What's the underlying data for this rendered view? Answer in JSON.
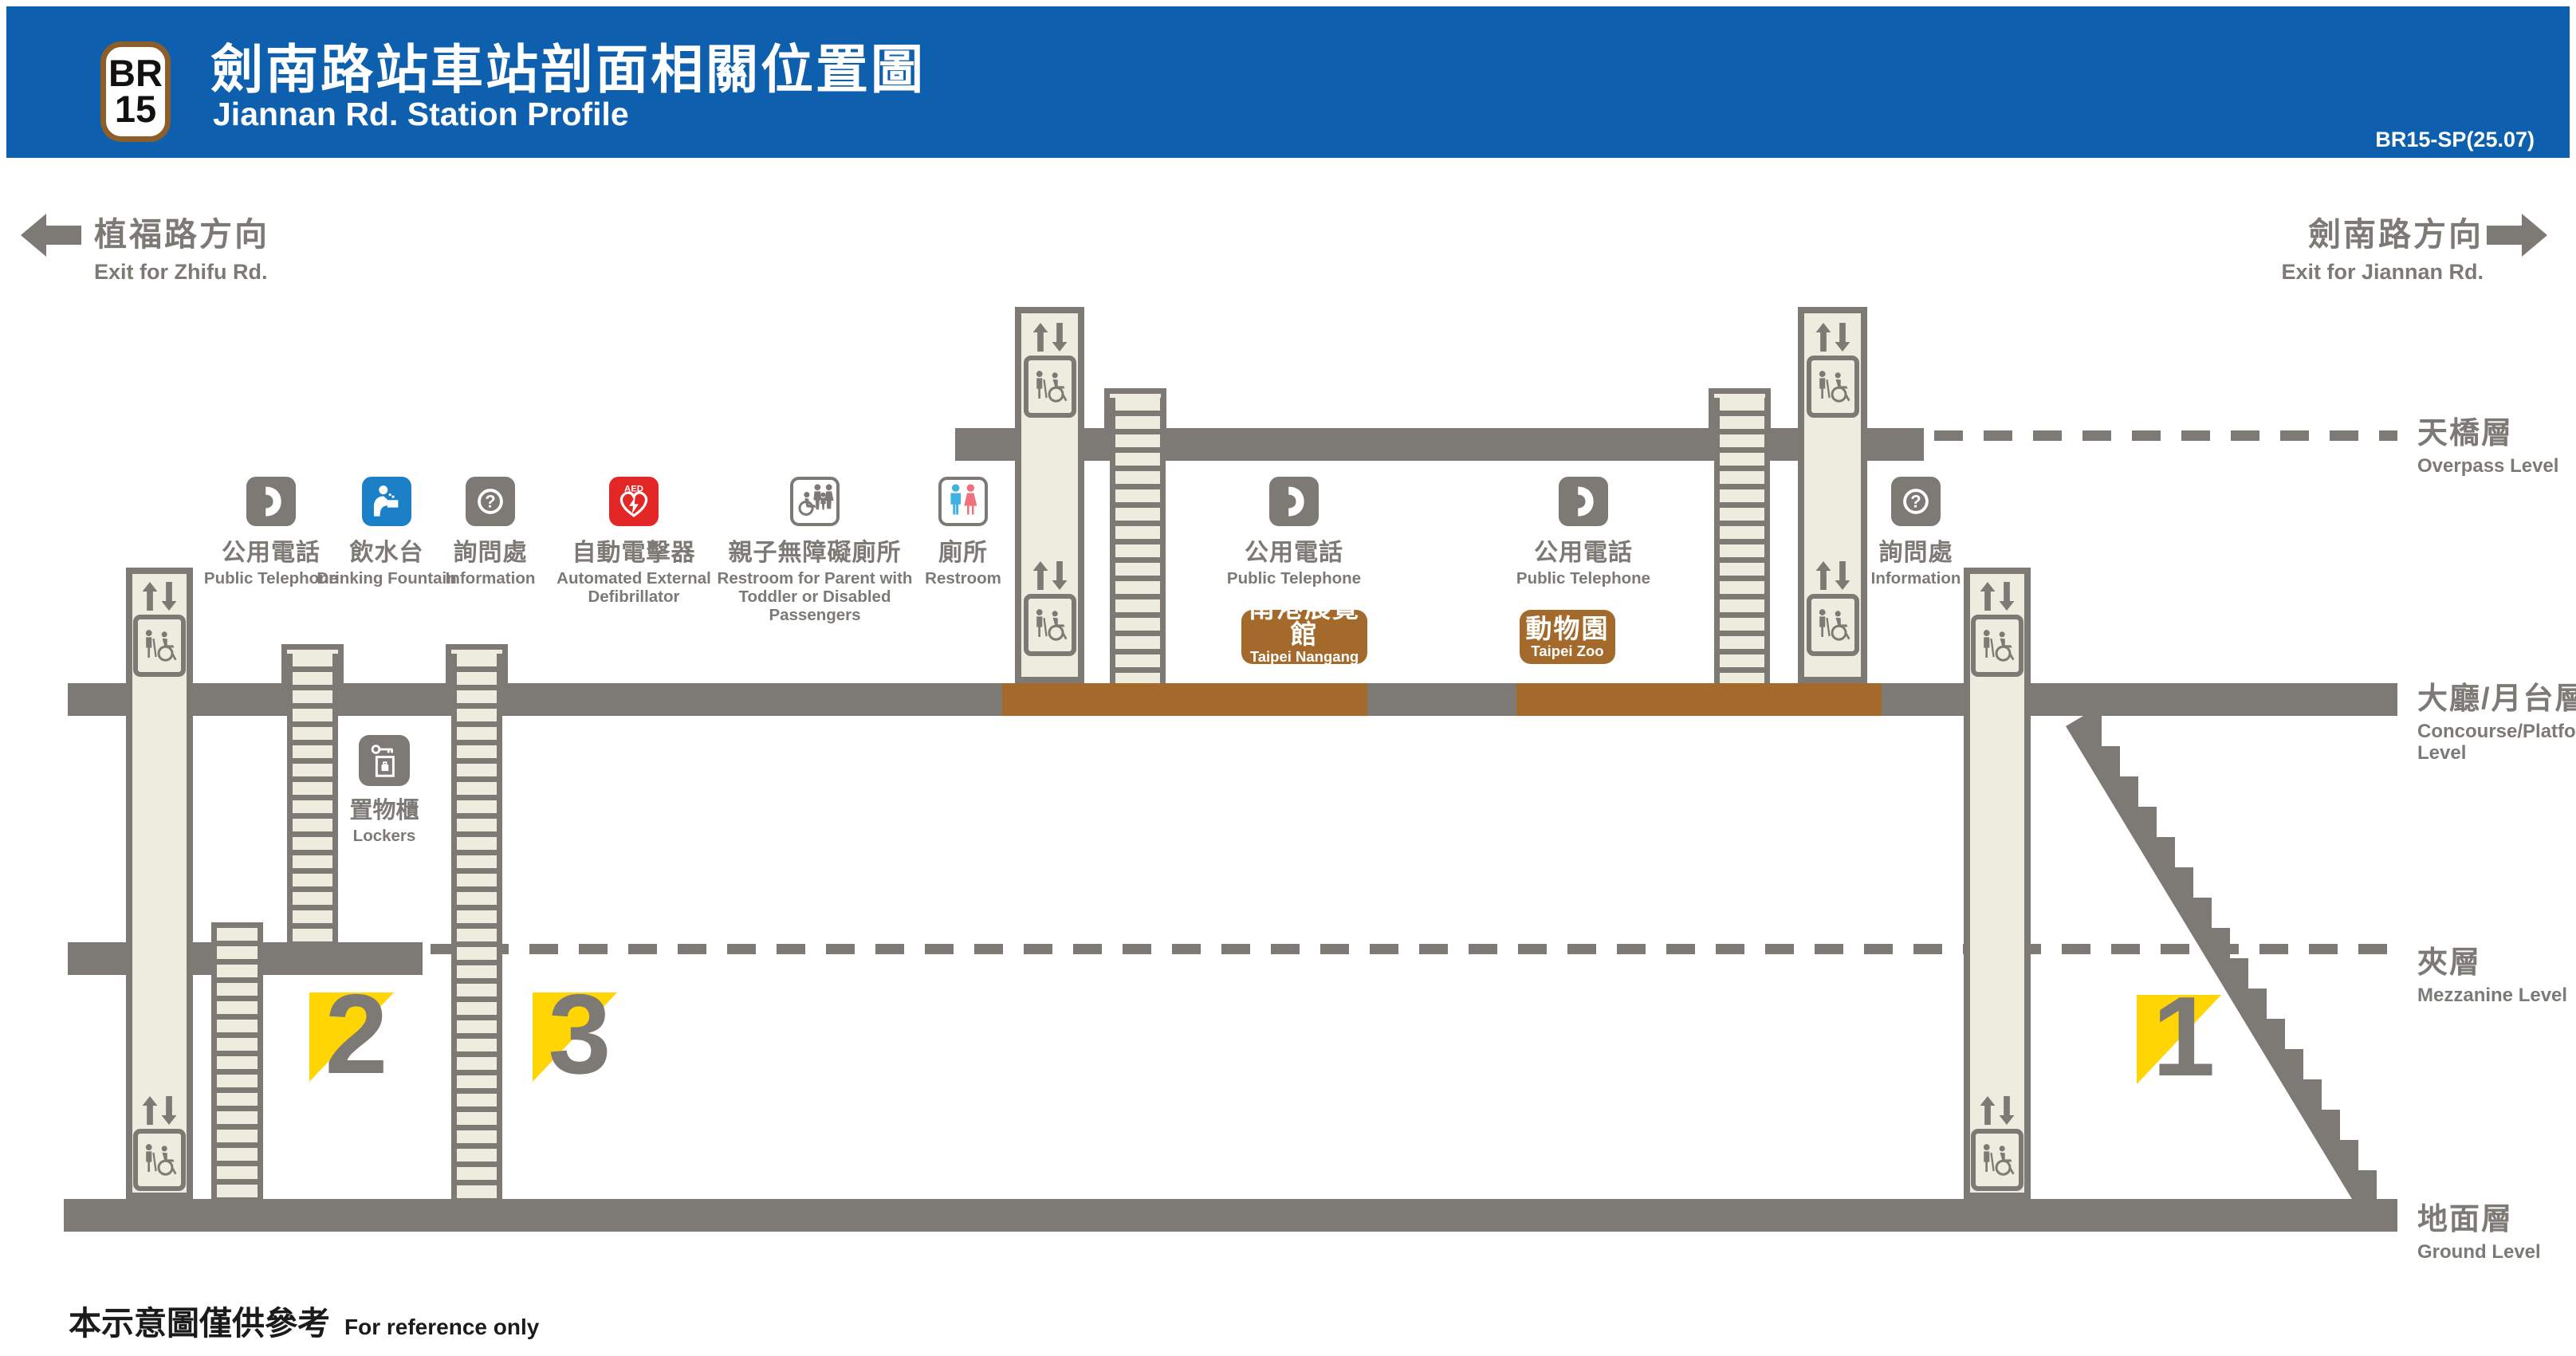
{
  "header": {
    "badge_line": "BR",
    "badge_number": "15",
    "title_zh": "劍南路站車站剖面相關位置圖",
    "title_en": "Jiannan Rd. Station Profile",
    "code": "BR15-SP(25.07)"
  },
  "directions": {
    "left": {
      "zh": "植福路方向",
      "en": "Exit for Zhifu Rd."
    },
    "right": {
      "zh": "劍南路方向",
      "en": "Exit for Jiannan Rd."
    }
  },
  "levels": {
    "overpass": {
      "zh": "天橋層",
      "en": "Overpass Level"
    },
    "concourse": {
      "zh": "大廳/月台層",
      "en1": "Concourse/Platform",
      "en2": "Level"
    },
    "mezzanine": {
      "zh": "夾層",
      "en": "Mezzanine Level"
    },
    "ground": {
      "zh": "地面層",
      "en": "Ground Level"
    }
  },
  "facilities": [
    {
      "id": "public-telephone-1",
      "zh": "公用電話",
      "en1": "Public Telephone"
    },
    {
      "id": "drinking-fountain",
      "zh": "飲水台",
      "en1": "Drinking Fountain"
    },
    {
      "id": "information-1",
      "zh": "詢問處",
      "en1": "Information"
    },
    {
      "id": "aed",
      "zh": "自動電擊器",
      "en1": "Automated External",
      "en2": "Defibrillator"
    },
    {
      "id": "family-restroom",
      "zh": "親子無障礙廁所",
      "en1": "Restroom for Parent with",
      "en2": "Toddler or Disabled Passengers"
    },
    {
      "id": "restroom",
      "zh": "廁所",
      "en1": "Restroom"
    },
    {
      "id": "public-telephone-2",
      "zh": "公用電話",
      "en1": "Public Telephone"
    },
    {
      "id": "public-telephone-3",
      "zh": "公用電話",
      "en1": "Public Telephone"
    },
    {
      "id": "information-2",
      "zh": "詢問處",
      "en1": "Information"
    }
  ],
  "signs": {
    "nangang": {
      "zh": "南港展覽館",
      "en1": "Taipei Nangang",
      "en2": "Exhibition Center"
    },
    "zoo": {
      "zh": "動物園",
      "en1": "Taipei Zoo"
    }
  },
  "lockers": {
    "zh": "置物櫃",
    "en": "Lockers"
  },
  "exits": [
    {
      "number": "2"
    },
    {
      "number": "3"
    },
    {
      "number": "1"
    }
  ],
  "footnote": {
    "zh": "本示意圖僅供參考",
    "en": "For reference only"
  },
  "colors": {
    "header_blue": "#0E5FAD",
    "structure_gray": "#7D7A75",
    "shaft_cream": "#EDECDF",
    "platform_brown": "#A36A2B",
    "badge_border_brown": "#8B5E2A",
    "exit_yellow": "#FFD503",
    "aed_red": "#E32726",
    "fountain_blue": "#1C80C7",
    "restroom_male_blue": "#41B1E1",
    "restroom_female_pink": "#EF717C"
  }
}
